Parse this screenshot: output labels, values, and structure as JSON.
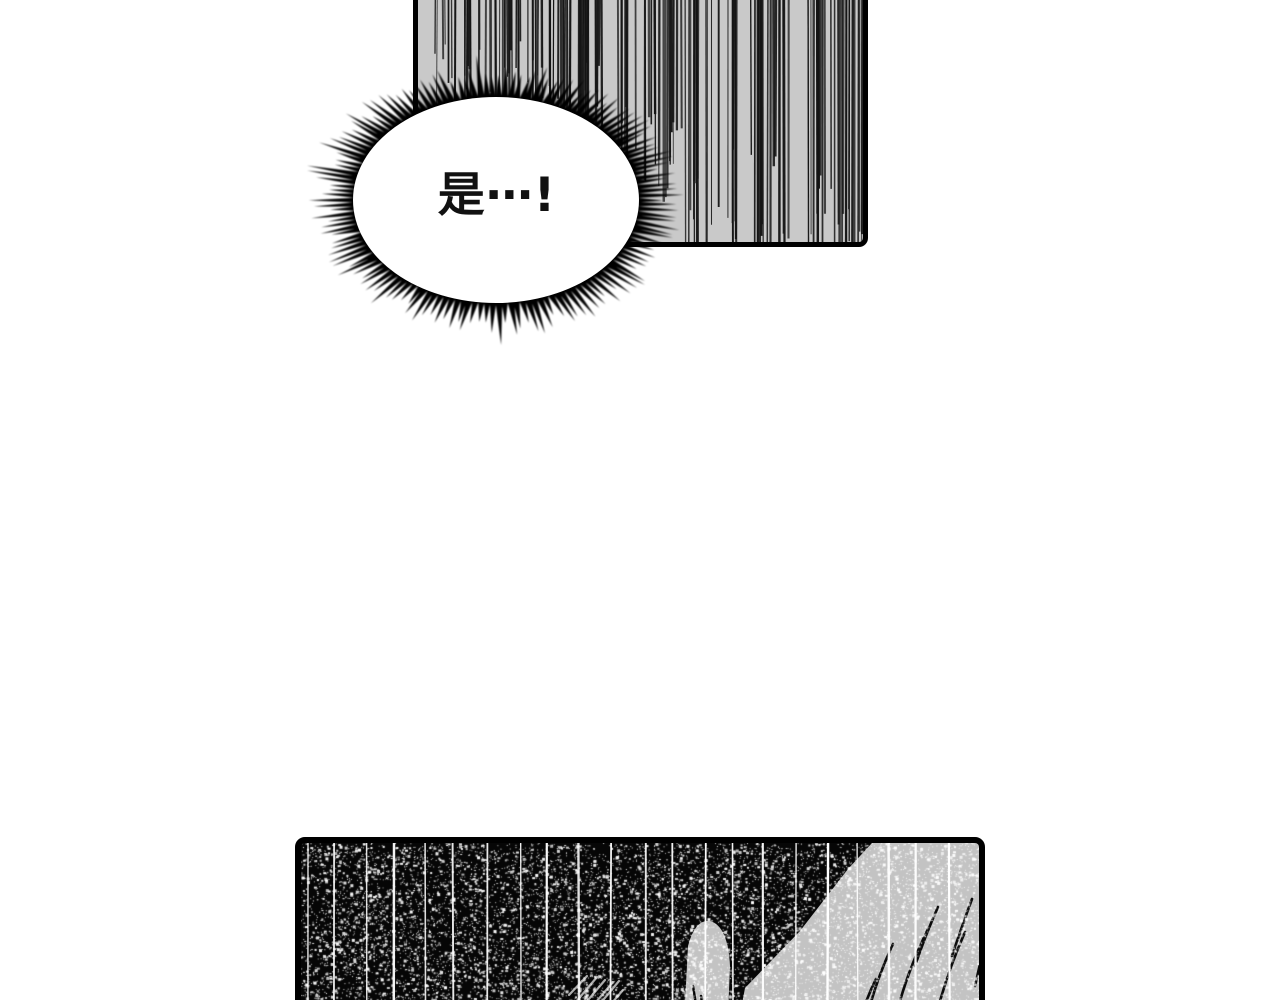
{
  "page": {
    "kind": "manga page",
    "background_color": "#ffffff",
    "border_color": "#000000"
  },
  "bubble": {
    "text": "是⋯!",
    "text_color": "#111111",
    "fill_color": "#ffffff",
    "spike_color": "#000000"
  },
  "panels": {
    "top": {
      "label": "speed-line flash panel",
      "fill_color": "#c9c9c9",
      "line_color": "#141414"
    },
    "bottom": {
      "label": "dark impact panel with claw streaks",
      "fill_color": "#060606",
      "streak_color": "#ffffff",
      "noise_color": "#ffffff",
      "shape_color": "#c3c3c3",
      "hatch_color": "#adadad",
      "slash_color": "#0a0a0a"
    }
  }
}
